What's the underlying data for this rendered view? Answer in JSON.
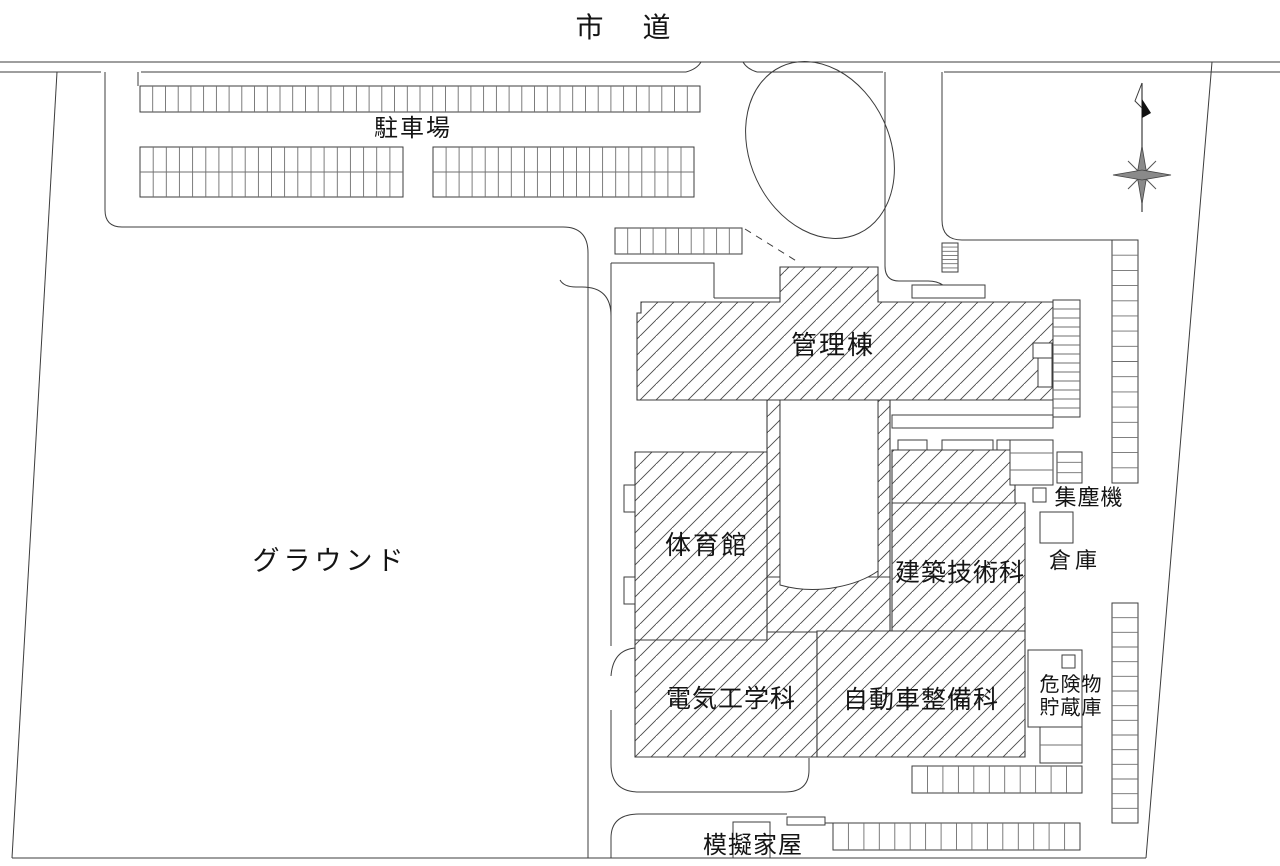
{
  "plan_title": "学校施設 配置図",
  "labels": [
    {
      "id": "shido",
      "text": "市 道",
      "x": 631,
      "y": 37,
      "size": 28,
      "ls": 16
    },
    {
      "id": "chushajo",
      "text": "駐車場",
      "x": 413,
      "y": 136,
      "size": 24,
      "ls": 2
    },
    {
      "id": "ground",
      "text": "グラウンド",
      "x": 330,
      "y": 570,
      "size": 27,
      "ls": 4
    },
    {
      "id": "kanrito",
      "text": "管理棟",
      "x": 833,
      "y": 354,
      "size": 26,
      "ls": 2
    },
    {
      "id": "taiikukan",
      "text": "体育館",
      "x": 707,
      "y": 554,
      "size": 26,
      "ls": 2
    },
    {
      "id": "kenchiku",
      "text": "建築技術科",
      "x": 960,
      "y": 581,
      "size": 25,
      "ls": 1
    },
    {
      "id": "denki",
      "text": "電気工学科",
      "x": 731,
      "y": 707,
      "size": 25,
      "ls": 1
    },
    {
      "id": "jidosha",
      "text": "自動車整備科",
      "x": 921,
      "y": 708,
      "size": 25,
      "ls": 1
    },
    {
      "id": "shujinki",
      "text": "集塵機",
      "x": 1089,
      "y": 505,
      "size": 22,
      "ls": 1
    },
    {
      "id": "soko",
      "text": "倉庫",
      "x": 1075,
      "y": 568,
      "size": 22,
      "ls": 4
    },
    {
      "id": "kikenbutsu1",
      "text": "危険物",
      "x": 1071,
      "y": 691,
      "size": 20,
      "ls": 1
    },
    {
      "id": "kikenbutsu2",
      "text": "貯蔵庫",
      "x": 1071,
      "y": 714,
      "size": 20,
      "ls": 1
    },
    {
      "id": "mogikaoku",
      "text": "模擬家屋",
      "x": 753,
      "y": 853,
      "size": 24,
      "ls": 1
    }
  ],
  "parking_strips": [
    {
      "name": "lot-top-row",
      "x": 140,
      "y": 86,
      "w": 560,
      "h": 26,
      "cells": 44,
      "dir": "v",
      "mid": false
    },
    {
      "name": "lot-block-west",
      "x": 140,
      "y": 147,
      "w": 263,
      "h": 50,
      "cells": 20,
      "dir": "v",
      "mid": true
    },
    {
      "name": "lot-block-east",
      "x": 433,
      "y": 147,
      "w": 261,
      "h": 50,
      "cells": 20,
      "dir": "v",
      "mid": true
    },
    {
      "name": "strip-near-admin",
      "x": 615,
      "y": 228,
      "w": 127,
      "h": 26,
      "cells": 10,
      "dir": "v",
      "mid": false
    },
    {
      "name": "crosswalk-steps",
      "x": 942,
      "y": 243,
      "w": 16,
      "h": 29,
      "cells": 7,
      "dir": "h",
      "mid": false
    },
    {
      "name": "stairs-east-admin",
      "x": 1053,
      "y": 300,
      "w": 27,
      "h": 117,
      "cells": 13,
      "dir": "h",
      "mid": false
    },
    {
      "name": "ladder-small",
      "x": 1057,
      "y": 452,
      "w": 25,
      "h": 31,
      "cells": 3,
      "dir": "h",
      "mid": false
    },
    {
      "name": "right-strip-upper",
      "x": 1112,
      "y": 240,
      "w": 26,
      "h": 243,
      "cells": 16,
      "dir": "h",
      "mid": false
    },
    {
      "name": "right-strip-lower",
      "x": 1112,
      "y": 603,
      "w": 26,
      "h": 220,
      "cells": 15,
      "dir": "h",
      "mid": false
    },
    {
      "name": "south-strip",
      "x": 912,
      "y": 766,
      "w": 170,
      "h": 27,
      "cells": 11,
      "dir": "v",
      "mid": false
    },
    {
      "name": "bottom-strip",
      "x": 833,
      "y": 823,
      "w": 247,
      "h": 27,
      "cells": 16,
      "dir": "v",
      "mid": false
    },
    {
      "name": "steps-hazmat",
      "x": 1040,
      "y": 727,
      "w": 42,
      "h": 36,
      "cells": 2,
      "dir": "h",
      "mid": false
    }
  ],
  "colors": {
    "line": "#3c3c3c",
    "divider": "#6f6f6f",
    "hatch": "#4a4a4a",
    "compass_fill": "#8a8a8a",
    "compass_dark": "#111111"
  }
}
